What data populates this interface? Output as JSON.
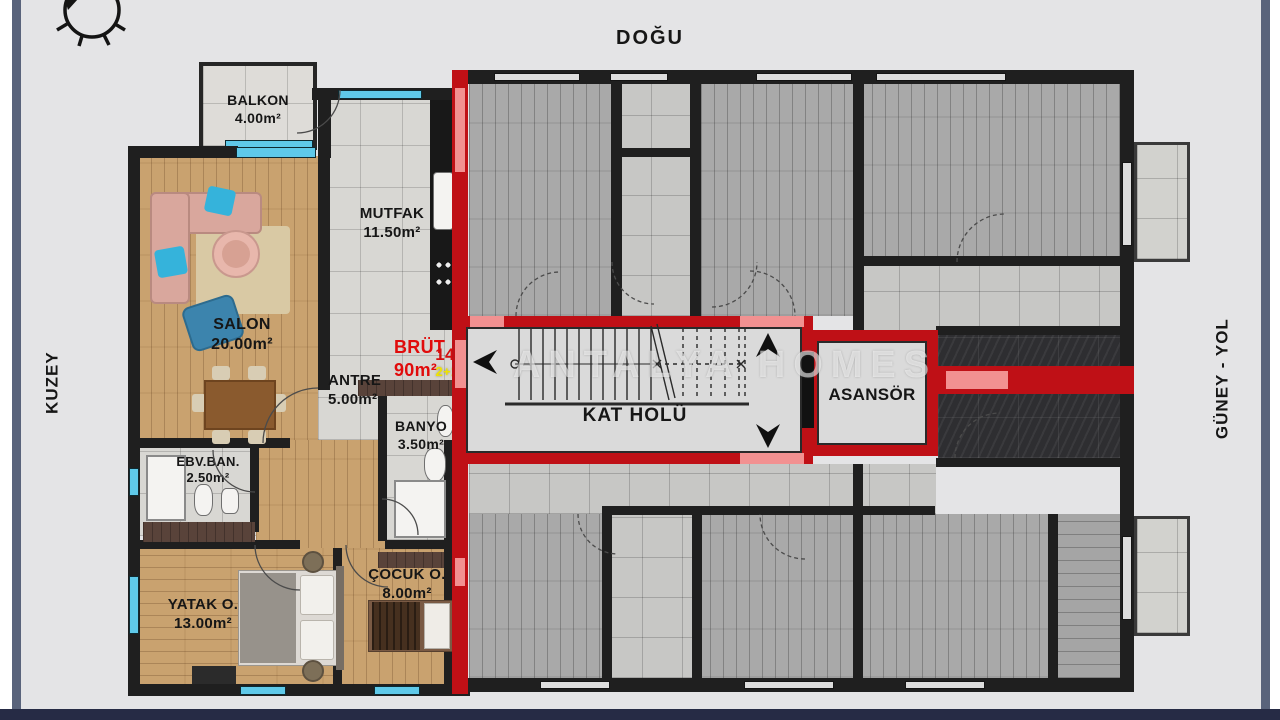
{
  "orientation": {
    "top": "DOĞU",
    "left": "KUZEY",
    "right": "GÜNEY - YOL"
  },
  "unit": {
    "gross_label": "BRÜT",
    "gross_area": "90m²",
    "number": "14",
    "type": "2+1"
  },
  "rooms": {
    "balkon": {
      "name": "BALKON",
      "area": "4.00m²"
    },
    "mutfak": {
      "name": "MUTFAK",
      "area": "11.50m²"
    },
    "salon": {
      "name": "SALON",
      "area": "20.00m²"
    },
    "antre": {
      "name": "ANTRE",
      "area": "5.00m²"
    },
    "banyo": {
      "name": "BANYO",
      "area": "3.50m²"
    },
    "ebv_ban": {
      "name": "EBV.BAN.",
      "area": "2.50m²"
    },
    "yatak": {
      "name": "YATAK O.",
      "area": "13.00m²"
    },
    "cocuk": {
      "name": "ÇOCUK O.",
      "area": "8.00m²"
    }
  },
  "common_areas": {
    "hall": "KAT HOLÜ",
    "elevator": "ASANSÖR"
  },
  "watermark": "ANTALYA HOMES",
  "colors": {
    "highlight_red": "#bf1016",
    "door_pink": "#f29191",
    "window_cyan": "#5fc9e9",
    "unit_number_red": "#d40f0f",
    "unit_type_yellow": "#f0e400",
    "wall_black": "#1f1f1f",
    "wood_tan": "#c9a26f",
    "frame_slate": "#59637b"
  }
}
